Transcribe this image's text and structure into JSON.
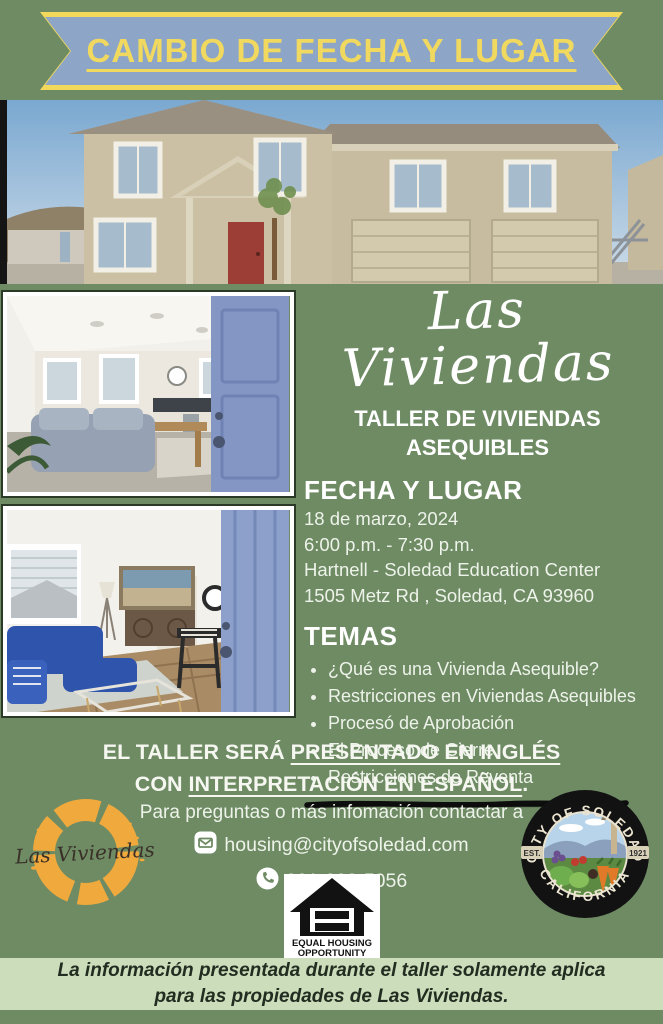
{
  "banner": {
    "text": "CAMBIO DE FECHA Y LUGAR"
  },
  "brand": {
    "script_title": "Las Viviendas",
    "subtitle": "TALLER DE VIVIENDAS ASEQUIBLES"
  },
  "fecha": {
    "heading": "FECHA Y LUGAR",
    "lines": [
      "18 de marzo, 2024",
      "6:00 p.m. - 7:30 p.m.",
      "Hartnell - Soledad Education Center",
      "1505 Metz Rd , Soledad, CA 93960"
    ]
  },
  "temas": {
    "heading": "TEMAS",
    "items": [
      "¿Qué es una Vivienda Asequible?",
      "Restricciones en Viviendas Asequibles",
      "Procesó de Aprobación",
      "El Proceso de Cierre",
      "Restricciones de Reventa"
    ]
  },
  "notice": {
    "line1_pre": "EL TALLER SERÁ ",
    "line1_underlined": "PRESENTADO EN INGLÉS",
    "line2_pre": "CON ",
    "line2_underlined": "INTERPRETACIÓN EN ESPAÑOL",
    "line2_end": "."
  },
  "contact": {
    "intro": "Para preguntas o más infomación contactar a",
    "email": "housing@cityofsoledad.com",
    "phone": "831-223-5056"
  },
  "logos": {
    "las_viviendas_text": "Las Viviendas",
    "eho_line1": "EQUAL HOUSING",
    "eho_line2": "OPPORTUNITY",
    "seal": {
      "arc_top": "CITY OF SOLEDAD",
      "arc_bottom": "CALIFORNIA",
      "est": "EST.",
      "year": "1921"
    }
  },
  "footer": {
    "text": "La información presentada durante el taller solamente aplica para las propiedades de Las Viviendas."
  },
  "icons": {
    "email": "envelope-icon",
    "phone": "phone-icon"
  },
  "colors": {
    "background": "#6e8b64",
    "ribbon_fill": "#8da5c6",
    "ribbon_border": "#f2d95c",
    "ribbon_text": "#f0d95e",
    "footer_band": "#cbddba",
    "body_text": "#ffffff",
    "marker_stroke": "#0d0d0d",
    "logo_orange": "#f0a93c"
  }
}
